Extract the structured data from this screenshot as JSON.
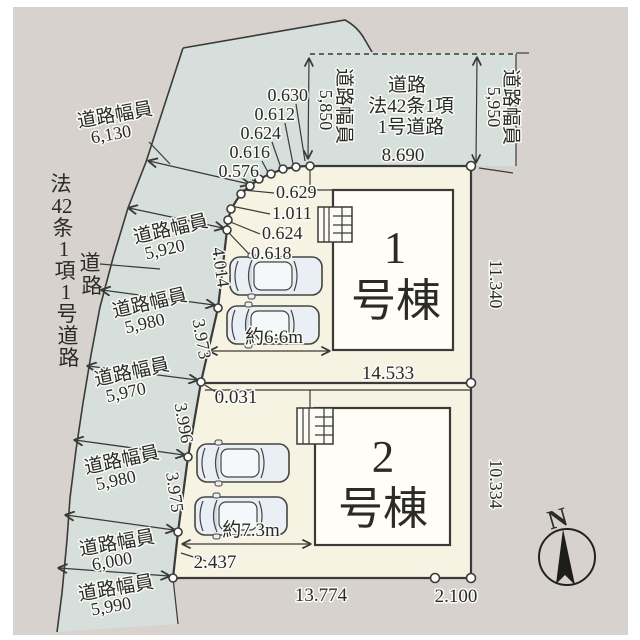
{
  "plan": {
    "colors": {
      "canvas_bg": "#d7d2cd",
      "road_fill": "#d6dfdc",
      "lot_fill": "#f7f3e2",
      "building_fill": "#fffdf6",
      "line": "#3a3a38"
    },
    "compass": {
      "label": "N"
    },
    "top_road": {
      "width_left_label": "道路幅員",
      "width_left_value": "5,850",
      "name_line1": "道路",
      "name_line2": "法42条1項",
      "name_line3": "1号道路",
      "width_right_label": "道路幅員",
      "width_right_value": "5,950",
      "frontage": "8.690"
    },
    "left_road": {
      "law": [
        "法",
        "42",
        "条",
        "1",
        "項",
        "1",
        "号",
        "道",
        "路"
      ],
      "callout": [
        "道",
        "路"
      ],
      "segments": [
        {
          "label": "道路幅員",
          "value": "6,130"
        },
        {
          "label": "道路幅員",
          "value": "5,920"
        },
        {
          "label": "道路幅員",
          "value": "5,980"
        },
        {
          "label": "道路幅員",
          "value": "5,970"
        },
        {
          "label": "道路幅員",
          "value": "5,980"
        },
        {
          "label": "道路幅員",
          "value": "6,000"
        },
        {
          "label": "道路幅員",
          "value": "5,990"
        }
      ]
    },
    "arc": [
      "0.630",
      "0.612",
      "0.624",
      "0.616",
      "0.576",
      "0.629",
      "1.011",
      "0.624",
      "0.618"
    ],
    "left_edge": {
      "seg_top": "4.014",
      "seg_2": "3.973",
      "offset": "0.031",
      "seg_3": "3.996",
      "seg_4": "3.975",
      "seg_5": "2.437"
    },
    "right_edge": {
      "lot1": "11.340",
      "lot2": "10.334"
    },
    "lots": [
      {
        "name_line1": "1",
        "name_line2": "号棟",
        "width": "14.533",
        "parking": "約6:6m"
      },
      {
        "name_line1": "2",
        "name_line2": "号棟",
        "width": "13.774",
        "parking": "約7.3m"
      }
    ],
    "bottom_right": "2.100"
  }
}
